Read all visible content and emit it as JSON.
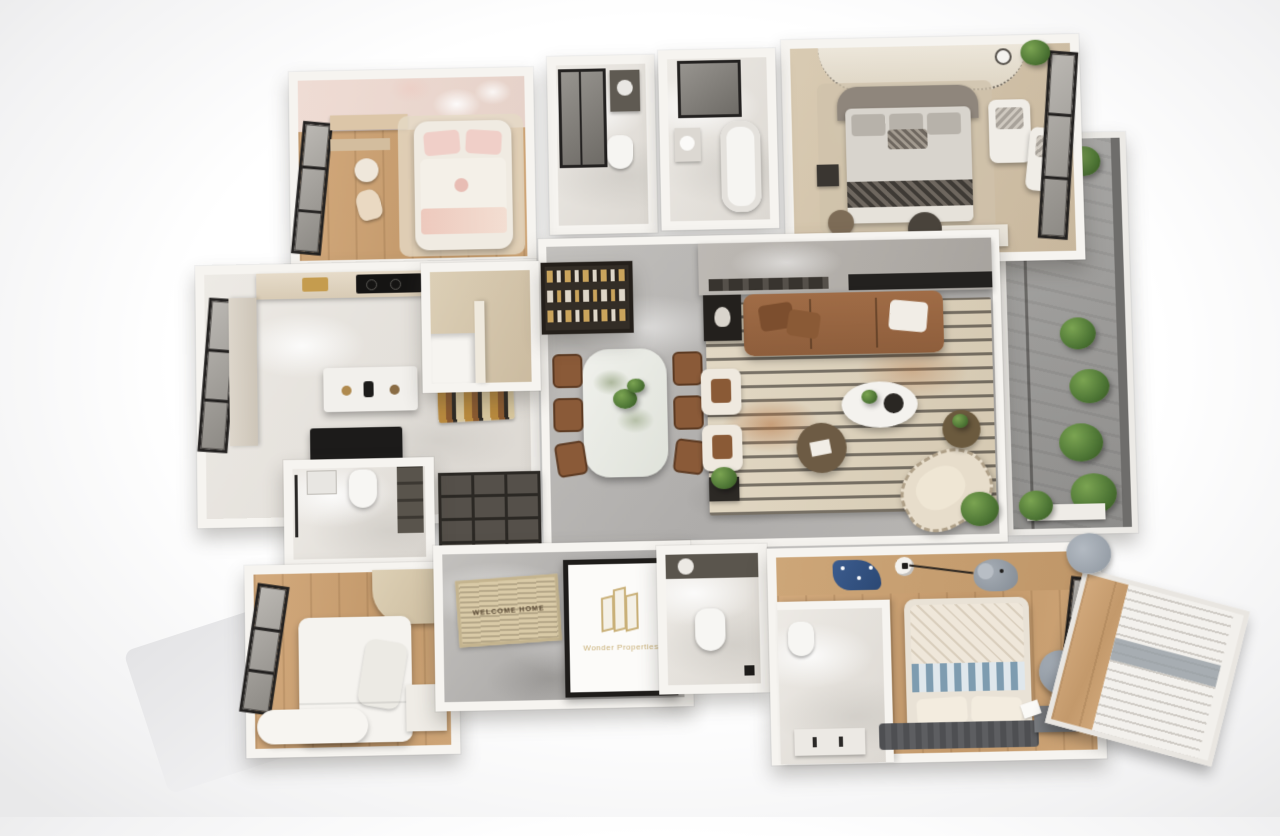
{
  "entry": {
    "door_logo": {
      "text": "Wonder Properties",
      "icon": "building-icon",
      "color": "#c9b078"
    },
    "doormat": {
      "text": "WELCOME HOME"
    }
  },
  "palette": {
    "background": "#ffffff",
    "wall_white": "#f6f4f0",
    "floor_marble_gray": "#b5b3b0",
    "floor_marble_white": "#e9e6e1",
    "floor_wood": "#c89e72",
    "floor_carpet_beige": "#d2c3ab",
    "balcony_stone": "#9d9c9a",
    "sofa_brown": "#9a6743",
    "dining_chair_brown": "#8a5a38",
    "kids_bed_pink": "#eecfc6",
    "kids_bed_blue_stripe": "#7e9cb0",
    "master_runner_dark": "#3e3a35",
    "window_frame_black": "#262422",
    "plant_green": "#4f7c3a",
    "logo_gold": "#c9b078",
    "living_rug_cream": "#ded3bf",
    "cooktop_black": "#151413"
  }
}
